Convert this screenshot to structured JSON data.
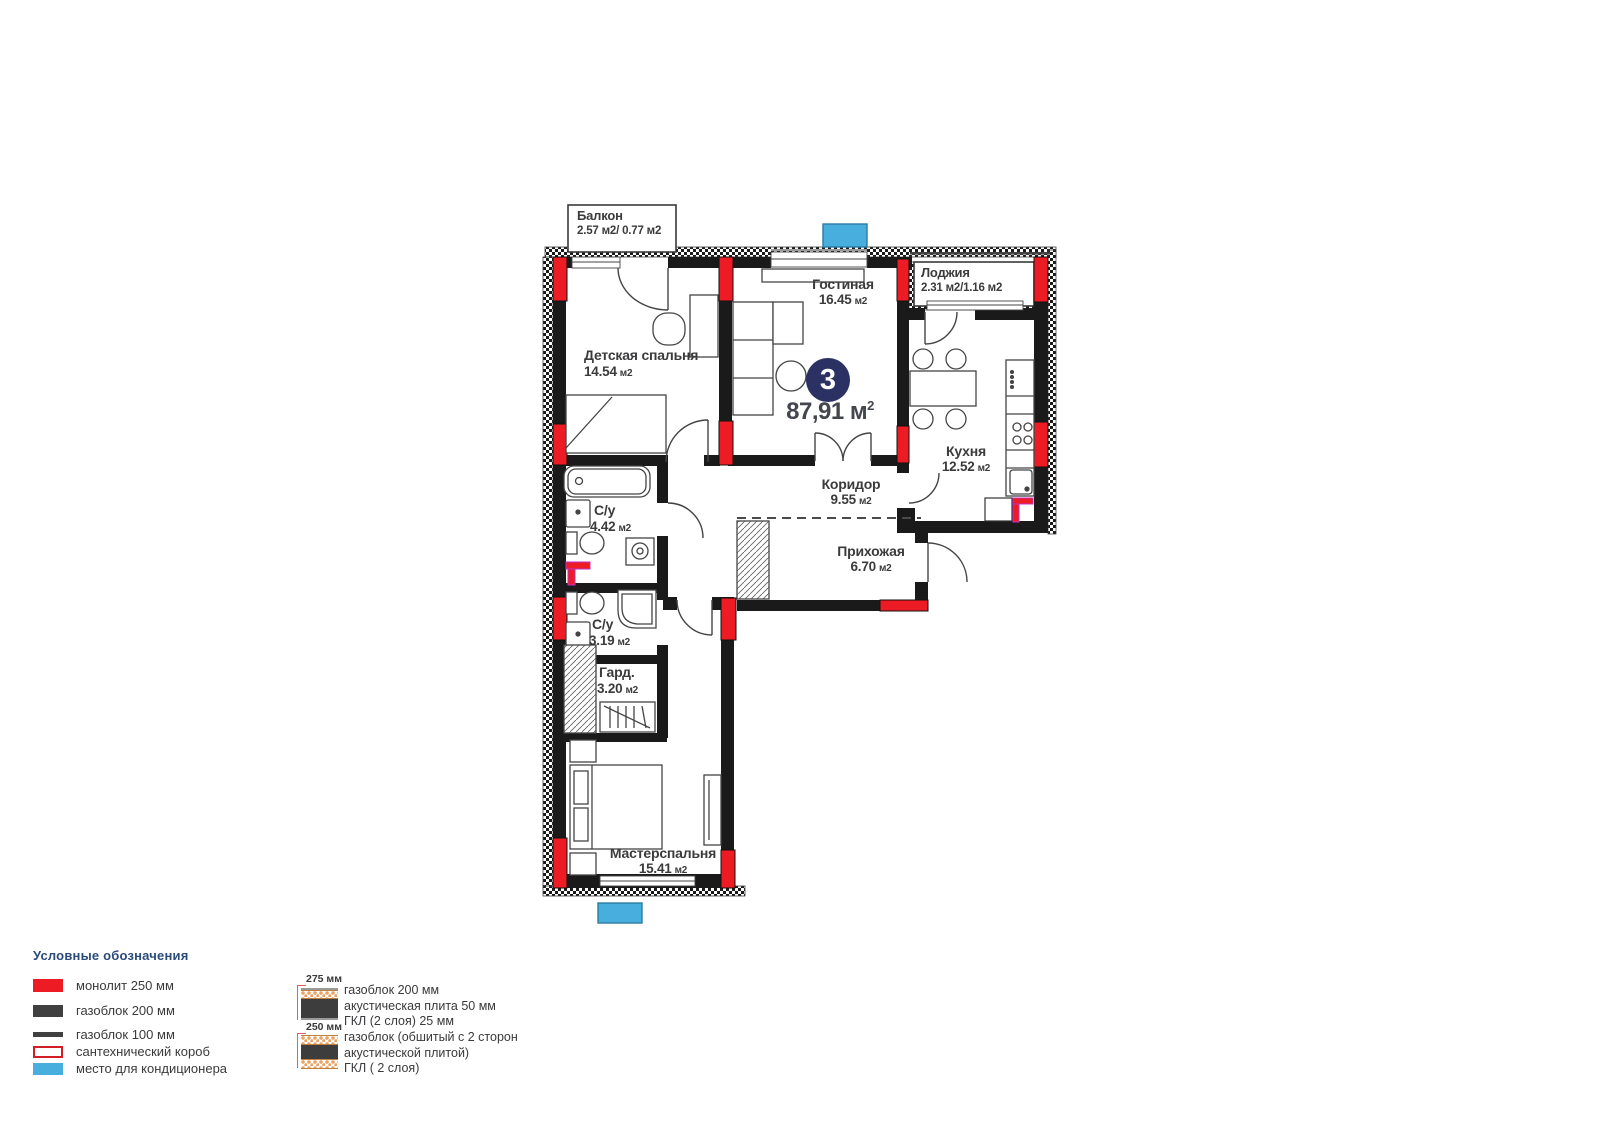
{
  "plan": {
    "badge": {
      "number": "3"
    },
    "total": {
      "value": "87,91",
      "unit": "м",
      "sup": "2"
    },
    "rooms": [
      {
        "id": "balcony",
        "name": "Балкон",
        "area": "2.57 м2/ 0.77 м2"
      },
      {
        "id": "nursery",
        "name": "Детская спальня",
        "area": "14.54",
        "unit": "м2"
      },
      {
        "id": "living",
        "name": "Гостиная",
        "area": "16.45",
        "unit": "м2"
      },
      {
        "id": "loggia",
        "name": "Лоджия",
        "area": "2.31 м2/1.16 м2"
      },
      {
        "id": "kitchen",
        "name": "Кухня",
        "area": "12.52",
        "unit": "м2"
      },
      {
        "id": "corridor",
        "name": "Коридор",
        "area": "9.55",
        "unit": "м2"
      },
      {
        "id": "bath1",
        "name": "С/у",
        "area": "4.42",
        "unit": "м2"
      },
      {
        "id": "hall",
        "name": "Прихожая",
        "area": "6.70",
        "unit": "м2"
      },
      {
        "id": "bath2",
        "name": "С/у",
        "area": "3.19",
        "unit": "м2"
      },
      {
        "id": "wardrobe",
        "name": "Гард.",
        "area": "3.20",
        "unit": "м2"
      },
      {
        "id": "master",
        "name": "Мастерспальня",
        "area": "15.41",
        "unit": "м2"
      }
    ]
  },
  "legend": {
    "title": "Условные обозначения",
    "items": [
      {
        "label": "монолит 250 мм"
      },
      {
        "label": "газоблок 200 мм"
      },
      {
        "label": "газоблок 100 мм"
      },
      {
        "label": "сантехнический короб"
      },
      {
        "label": "место для кондиционера"
      }
    ],
    "wall_types": [
      {
        "dim": "275 мм",
        "lines": [
          "газоблок 200 мм",
          "акустическая плита 50 мм",
          "ГКЛ (2 слоя) 25 мм"
        ]
      },
      {
        "dim": "250 мм",
        "lines": [
          "газоблок (обшитый с 2 сторон",
          "акустической плитой)",
          "ГКЛ ( 2 слоя)"
        ]
      }
    ]
  },
  "colors": {
    "monolith": "#ed1c24",
    "gasblock": "#404040",
    "ac": "#47aede",
    "badge": "#2b3263",
    "legend_title": "#2a4b7c"
  }
}
